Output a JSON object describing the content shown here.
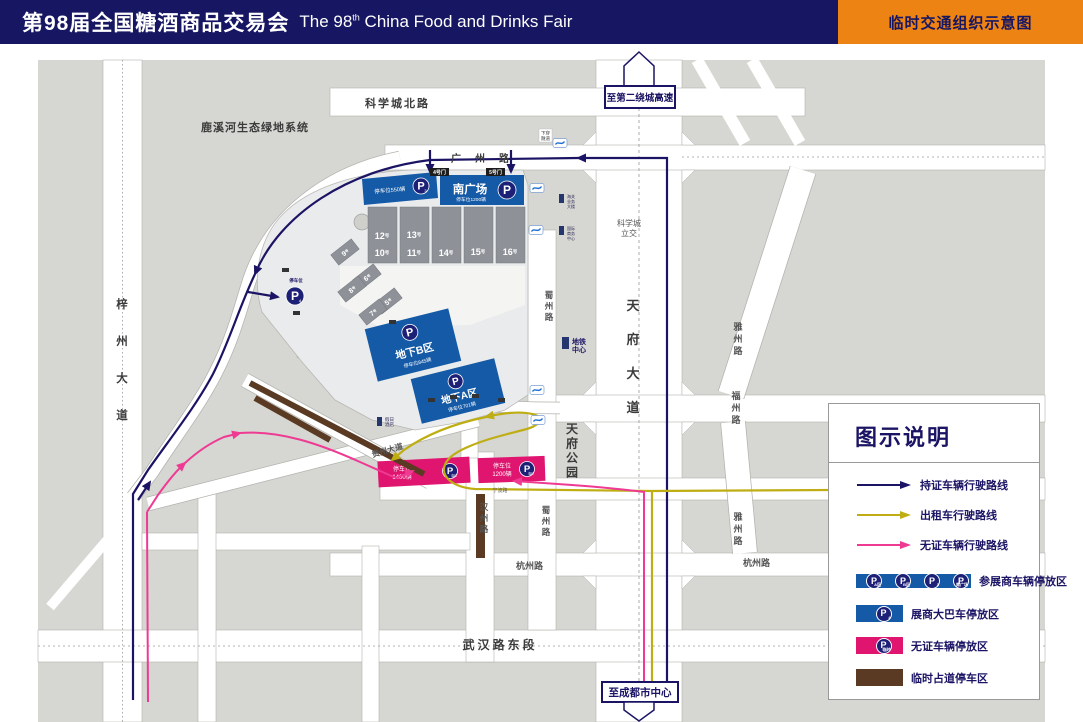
{
  "header": {
    "title_cn": "第98届全国糖酒商品交易会",
    "title_en_pre": "The 98",
    "title_en_sup": "th",
    "title_en_post": " China Food and Drinks Fair",
    "badge": "临时交通组织示意图"
  },
  "signs": {
    "north": "至第二绕城高速",
    "south": "至成都市中心",
    "interchange_line1": "科学城",
    "interchange_line2": "立交"
  },
  "roads": {
    "kxc_north": "科学城北路",
    "guangzhou": "广州路",
    "tianfu": "天府大道",
    "zizhou": "梓州大道",
    "yazhou_n": "雅州路",
    "yazhou_s": "雅州路",
    "fuzhou_e": "福州路",
    "fuzhou_w": "福州路",
    "ningbo_e": "宁波路",
    "ningbo_w": "宁波路",
    "hangzhou_e": "杭州路",
    "hangzhou_w": "杭州路",
    "wuhan": "武汉路东段",
    "shuzhou_n": "蜀州路",
    "shuzhou_s": "蜀州路",
    "hanzhou": "汉州路",
    "guizhou": "贵州大道"
  },
  "areas": {
    "luxihe": "鹿溪河生态绿地系统",
    "tianfu_park": "天府公园"
  },
  "halls": {
    "suffix": "号",
    "h5": "5",
    "h6": "6",
    "h7": "7",
    "h8": "8",
    "h9": "9",
    "h10": "10",
    "h11": "11",
    "h12": "12",
    "h13": "13",
    "h14": "14",
    "h15": "15",
    "h16": "16"
  },
  "parking": {
    "p3": {
      "p": "P",
      "sub": "3",
      "cap": "停车位550辆"
    },
    "south_plaza": {
      "name": "南广场",
      "p": "P",
      "cap": "停车位1200辆"
    },
    "underground_b": {
      "name": "地下B区",
      "p": "P",
      "cap": "停车位845辆"
    },
    "underground_a": {
      "name": "地下A区",
      "p": "P",
      "cap": "停车位701辆"
    },
    "p4": {
      "p": "P",
      "sub": "4",
      "cap": "停车位"
    },
    "temp1": {
      "p": "P",
      "sub": "临时",
      "cap_line1": "停车位",
      "cap_line2": "1400辆"
    },
    "temp2": {
      "p": "P",
      "sub": "临时",
      "cap_line1": "停车位",
      "cap_line2": "1200辆"
    }
  },
  "gates": {
    "g4": "4号门",
    "g5": "5号门"
  },
  "buildings": {
    "customs": [
      "海关",
      "业务",
      "大楼"
    ],
    "intl": [
      "国际",
      "商务",
      "中心"
    ],
    "metro_center": [
      "地铁",
      "中心"
    ],
    "hotel": [
      "假日",
      "酒店"
    ],
    "tunnel": [
      "下穿",
      "隧道"
    ]
  },
  "legend": {
    "title": "图示说明",
    "routes": [
      {
        "label": "持证车辆行驶路线",
        "color": "#1b1464"
      },
      {
        "label": "出租车行驶路线",
        "color": "#bfae13"
      },
      {
        "label": "无证车辆行驶路线",
        "color": "#ee3a93"
      }
    ],
    "p_badges": [
      {
        "p": "P",
        "sub": "A区"
      },
      {
        "p": "P",
        "sub": "B区"
      },
      {
        "p": "P",
        "sub": "3"
      },
      {
        "p": "P",
        "sub": "南广场"
      }
    ],
    "p4_badge": {
      "p": "P",
      "sub": "4"
    },
    "ptemp_badge": {
      "p": "P",
      "sub": "临时"
    },
    "parkings": [
      {
        "label": "参展商车辆停放区"
      },
      {
        "label": "展商大巴车停放区"
      },
      {
        "label": "无证车辆停放区"
      },
      {
        "label": "临时占道停车区"
      }
    ]
  },
  "colors": {
    "header_navy": "#161663",
    "accent_orange": "#ed8312",
    "route_permit": "#1b1464",
    "route_taxi": "#bfae13",
    "route_nopermit": "#ee3a93",
    "parking_blue": "#155aa6",
    "parking_pink": "#e0156f",
    "roadside_brown": "#5a3a22"
  }
}
